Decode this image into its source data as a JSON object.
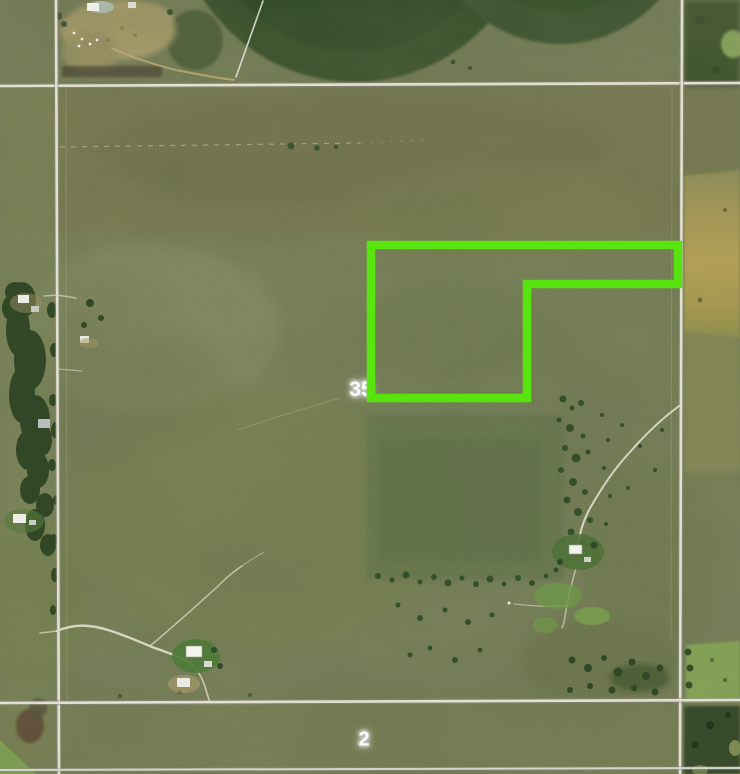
{
  "map": {
    "description": "Aerial satellite parcel map with highlighted property boundary",
    "section_labels": [
      {
        "text": "35"
      },
      {
        "text": "2"
      }
    ],
    "parcel": {
      "points": "371,245 678,245 678,284 527,284 527,398 371,398",
      "stroke_color": "#57E40F",
      "stroke_width": 8.5
    },
    "palette": {
      "label_text": "#FBFBFB",
      "label_halo": "#C6C6BF",
      "parcel_green": "#57E40F",
      "grass_base": "#78805A",
      "road_line": "#E3E0D2",
      "crop_circle_dark": "#35502B",
      "stubble_field_tan": "#B5A156",
      "woods_dark": "#2C4323"
    }
  }
}
